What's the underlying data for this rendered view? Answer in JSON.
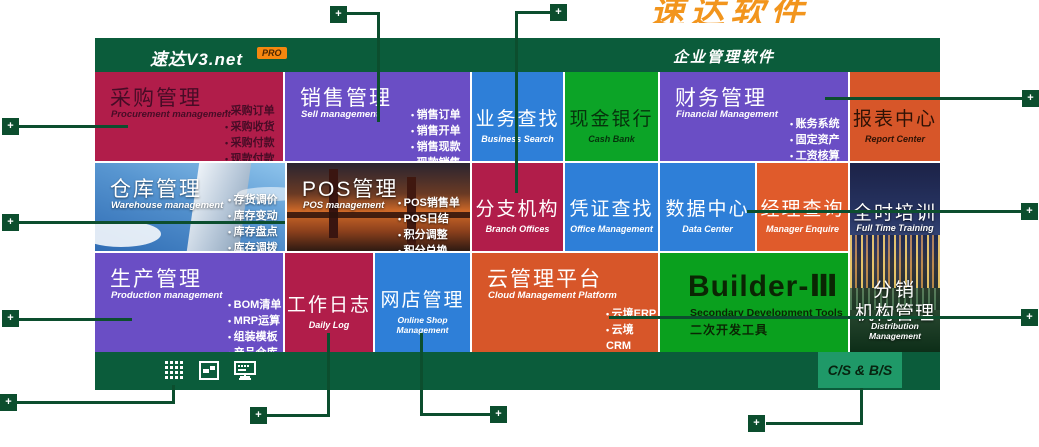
{
  "watermark": {
    "text": "速达软件"
  },
  "header": {
    "logo": "速达V3.net",
    "badge": "PRO",
    "product_title": "企业管理软件"
  },
  "tiles": {
    "purchase": {
      "title": "采购管理",
      "subtitle": "Procurement management",
      "items": [
        "采购订单",
        "采购收货",
        "采购付款",
        "现款付款"
      ]
    },
    "sales": {
      "title": "销售管理",
      "subtitle": "Sell management",
      "items": [
        "销售订单",
        "销售开单",
        "销售现款",
        "现款销售"
      ]
    },
    "business_search": {
      "title": "业务查找",
      "subtitle": "Business Search"
    },
    "cash_bank": {
      "title": "现金银行",
      "subtitle": "Cash Bank"
    },
    "finance": {
      "title": "财务管理",
      "subtitle": "Financial Management",
      "items": [
        "账务系统",
        "固定资产",
        "工资核算"
      ]
    },
    "report": {
      "title": "报表中心",
      "subtitle": "Report Center"
    },
    "warehouse": {
      "title": "仓库管理",
      "subtitle": "Warehouse management",
      "items": [
        "存货调价",
        "库存变动",
        "库存盘点",
        "库存调拨"
      ]
    },
    "pos": {
      "title": "POS管理",
      "subtitle": "POS management",
      "items": [
        "POS销售单",
        "POS日结",
        "积分调整",
        "积分兑换"
      ]
    },
    "branch": {
      "title": "分支机构",
      "subtitle": "Branch Offices"
    },
    "voucher": {
      "title": "凭证查找",
      "subtitle": "Office Management"
    },
    "data_center": {
      "title": "数据中心",
      "subtitle": "Data Center"
    },
    "manager": {
      "title": "经理查询",
      "subtitle": "Manager Enquire"
    },
    "training": {
      "title": "全时培训",
      "subtitle": "Full Time Training"
    },
    "production": {
      "title": "生产管理",
      "subtitle": "Production management",
      "items": [
        "BOM清单",
        "MRP运算",
        "组装模板",
        "产品仓库"
      ]
    },
    "daily_log": {
      "title": "工作日志",
      "subtitle": "Daily Log"
    },
    "online_shop": {
      "title": "网店管理",
      "subtitle": "Online Shop Management"
    },
    "cloud": {
      "title": "云管理平台",
      "subtitle": "Cloud Management Platform",
      "items": [
        "云境ERP",
        "云境CRM",
        "云境SOHO"
      ]
    },
    "builder": {
      "title": "Builder-Ⅲ",
      "subtitle_en": "Secondary Development Tools",
      "subtitle_cn": "二次开发工具"
    },
    "distribution": {
      "title_line1": "分销",
      "title_line2": "机构管理",
      "subtitle": "Distribution Management"
    }
  },
  "footer": {
    "cs_bs": "C/S & B/S",
    "icons": [
      "grid-icon",
      "image-icon",
      "monitor-icon"
    ]
  },
  "icons": {
    "plus": "+"
  },
  "colors": {
    "header_green": "#0b5c3b",
    "marker_green": "#0c4e2e",
    "crimson": "#b11d4a",
    "purple": "#6a4ec5",
    "blue": "#2e7fd8",
    "bright_green": "#0ca427",
    "builder_green": "#0aa01e",
    "orange_red": "#d75629",
    "orange": "#e05b2b",
    "badge_orange": "#f6870f",
    "watermark_orange": "#f2951d",
    "csbs_green": "#1f9968"
  }
}
